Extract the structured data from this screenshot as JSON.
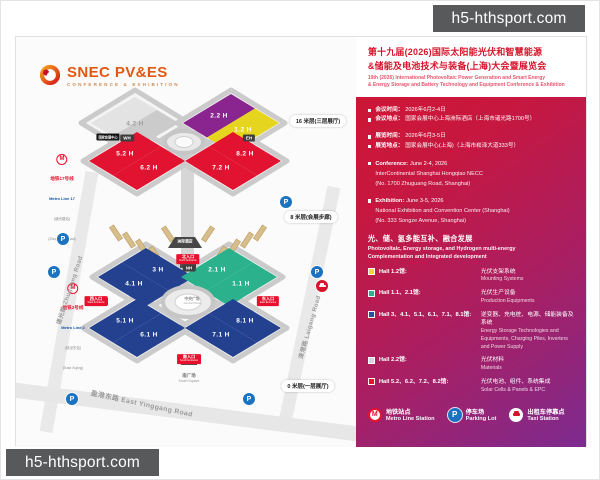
{
  "watermark": {
    "text": "h5-hthsport.com"
  },
  "logo": {
    "name": "SNEC PV&ES",
    "tagline": "CONFERENCE & EXHIBITION"
  },
  "map": {
    "floor_labels": [
      "16 米层(三层展厅)",
      "8 米层(会展步廊)",
      "0 米层(一层展厅)"
    ],
    "halls": [
      {
        "label": "4.2 H"
      },
      {
        "label": "2.2 H"
      },
      {
        "label": "1.2 H"
      },
      {
        "label": "5.2 H"
      },
      {
        "label": "6.2 H"
      },
      {
        "label": "8.2 H"
      },
      {
        "label": "7.2 H"
      },
      {
        "label": "3 H"
      },
      {
        "label": "4.1 H"
      },
      {
        "label": "2.1 H"
      },
      {
        "label": "1.1 H"
      },
      {
        "label": "5.1 H"
      },
      {
        "label": "6.1 H"
      },
      {
        "label": "8.1 H"
      },
      {
        "label": "7.1 H"
      }
    ],
    "entrances": [
      {
        "cn": "北入口",
        "en": "North Entrance"
      },
      {
        "cn": "西入口",
        "en": "West Entrance"
      },
      {
        "cn": "东入口",
        "en": "East Entrance"
      },
      {
        "cn": "南入口",
        "en": "South Entrance"
      }
    ],
    "landmarks": {
      "wh": "WH",
      "eh": "EH",
      "nh": "NH",
      "hotel": "洲际酒店",
      "necc": "国家会展中心",
      "central_plaza_cn": "中央广场",
      "central_plaza_en": "Central Plaza",
      "south_square_cn": "南广场",
      "south_square_en": "South Square"
    },
    "roads": [
      "诸光路 Zhuguang Road",
      "涞港路 Laigang Road",
      "盈港东路 East Yinggang Road"
    ],
    "metro_stations": [
      {
        "line_cn": "地铁17号线",
        "line_en": "Metro Line 17",
        "station_cn": "(诸光路站)",
        "station_en": "(Zhuguang Road)"
      },
      {
        "line_cn": "地铁2号线",
        "line_en": "Metro Line 2",
        "station_cn": "(徐泾东站)",
        "station_en": "(East Xujing)"
      }
    ],
    "icons": {
      "metro": "M",
      "parking": "P"
    },
    "colors": {
      "hall_red": "#e21330",
      "hall_purple": "#8a2590",
      "hall_yellow": "#e6d51f",
      "hall_blue": "#24418f",
      "hall_green": "#2bb28c",
      "hall_gray": "#cbcbcb"
    }
  },
  "panel": {
    "title_cn_1": "第十九届(2026)国际太阳能光伏和智慧能源",
    "title_cn_2": "&储能及电池技术与装备(上海)大会暨展览会",
    "title_en_1": "19th (2026) International Photovoltaic Power Generation and Smart Energy",
    "title_en_2": "& Energy Storage and Battery Technology and Equipment Conference & Exhibition",
    "info_cn": [
      {
        "label": "会议时间：",
        "value": "2026年6月2-4日"
      },
      {
        "label": "会议地点：",
        "value": "国家会展中心上海洲际酒店（上海市诸光路1700号）"
      },
      {
        "label": "展览时间：",
        "value": "2026年6月3-5日"
      },
      {
        "label": "展览地点：",
        "value": "国家会展中心(上海)（上海市崧泽大道333号）"
      }
    ],
    "info_en": [
      {
        "label": "Conference:",
        "value": "June 2-4, 2026",
        "line1": "InterContinental Shanghai Hongqiao NECC",
        "line2": "(No. 1700 Zhuguang Road, Shanghai)"
      },
      {
        "label": "Exhibition:",
        "value": "June 3-5, 2026",
        "line1": "National Exhibition and Convention Center (Shanghai)",
        "line2": "(No. 333 Songze Avenue, Shanghai)"
      }
    ],
    "theme_cn": "光、储、氢多能互补、融合发展",
    "theme_en_1": "Photovoltaic, Energy storage, and Hydrogen multi-energy",
    "theme_en_2": "Complementation and Integrated development",
    "legend": [
      {
        "color": "#f2d53a",
        "label": "Hall 1.2馆:",
        "desc_cn": "光伏支架系统",
        "desc_en": "Mounting Systems"
      },
      {
        "color": "#2fae92",
        "label": "Hall 1.1、2.1馆:",
        "desc_cn": "光伏生产设备",
        "desc_en": "Production Equipments"
      },
      {
        "color": "#2b4fa0",
        "label": "Hall 3、4.1、5.1、6.1、7.1、8.1馆:",
        "desc_cn": "逆变器、充电桩、电源、储能装备及系统",
        "desc_en": "Energy Storage Technologies and Equipments, Charging Piles, Inverters and Power Supply"
      },
      {
        "color": "#d9d2e6",
        "label": "Hall 2.2馆:",
        "desc_cn": "光伏材料",
        "desc_en": "Materials"
      },
      {
        "color": "#e8112d",
        "label": "Hall 5.2、6.2、7.2、8.2馆:",
        "desc_cn": "光伏电池、组件、系统集成",
        "desc_en": "Solar Cells & Panels & EPC"
      }
    ],
    "facilities": [
      {
        "cn": "地铁站点",
        "en": "Metro Line Station"
      },
      {
        "cn": "停车场",
        "en": "Parking Lot"
      },
      {
        "cn": "出租车停靠点",
        "en": "Taxi Station"
      }
    ]
  }
}
